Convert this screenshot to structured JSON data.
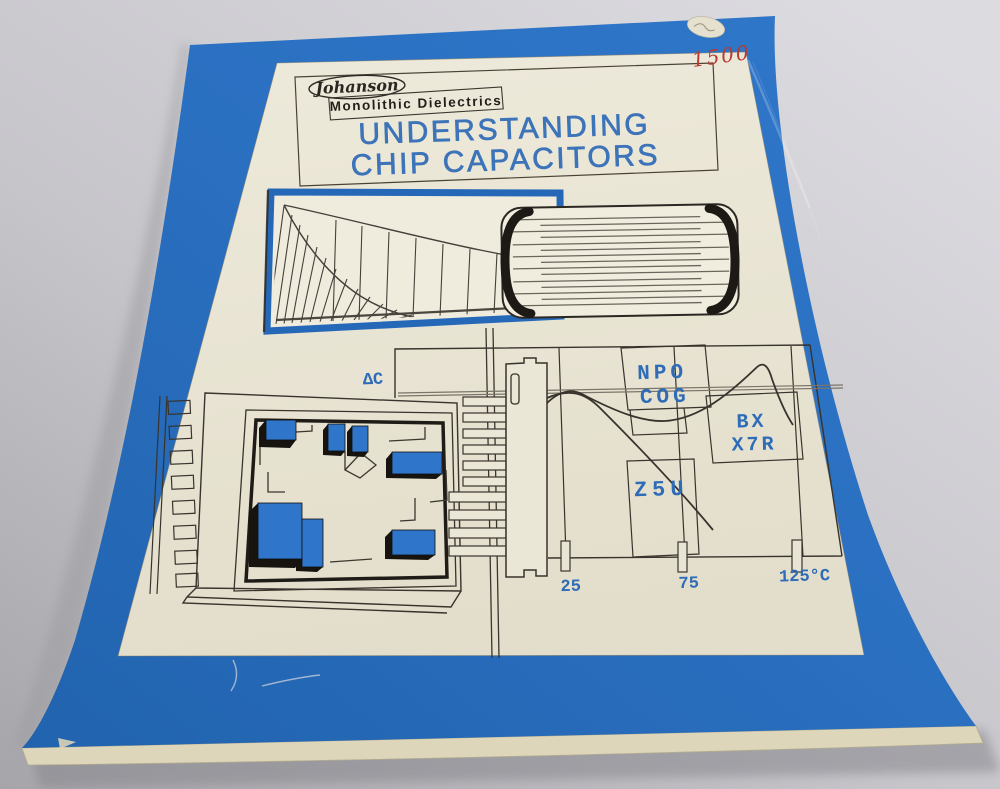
{
  "cover": {
    "brand_script": "Johanson",
    "brand_subtitle": "Monolithic Dielectrics",
    "title_line1": "UNDERSTANDING",
    "title_line2": "CHIP CAPACITORS",
    "handwritten_price": "1500"
  },
  "figures": {
    "temperature_chart": {
      "type": "line",
      "delta_label": "ΔC",
      "x_ticks": [
        "25",
        "75",
        "125°C"
      ],
      "series_labels": {
        "npo1": "NPO",
        "npo2": "COG",
        "bx1": "BX",
        "bx2": "X7R",
        "z5u": "Z5U"
      }
    }
  },
  "colors": {
    "cover_blue": "#2a70c2",
    "panel_cream": "#e9e5d4",
    "label_blue": "#2f6cb8",
    "title_blue": "#3d74b9",
    "handwriting_red": "#b93a30",
    "line_ink": "#38332c",
    "surface_gray": "#c7c6cb",
    "page_edge": "#ddd6ba"
  }
}
